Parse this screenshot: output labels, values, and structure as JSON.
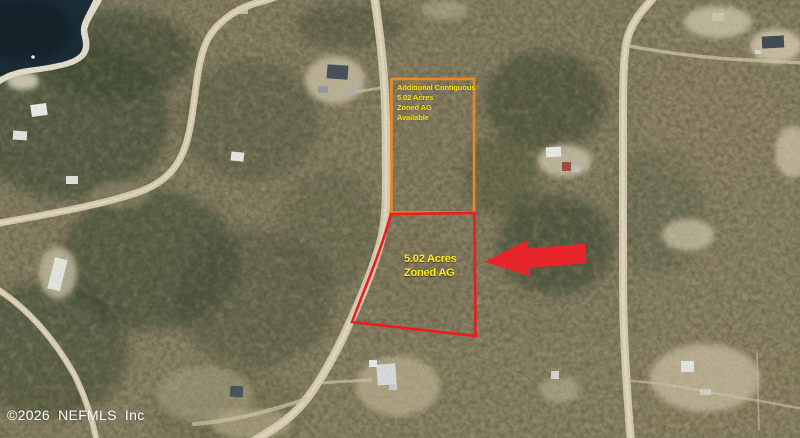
{
  "map": {
    "type": "aerial-parcel-map",
    "watermark": "©2026 NEFMLS Inc",
    "annotations": {
      "contiguous_parcel": {
        "outline_color": "#f08621",
        "label_color": "#ffe81c",
        "lines": [
          "Additional Contiguous",
          "5.02 Acres",
          "Zoned AG",
          "Available"
        ]
      },
      "subject_parcel": {
        "outline_color": "#ee1b1b",
        "label_color": "#ffe81c",
        "lines": [
          "5.02 Acres",
          "Zoned AG"
        ]
      },
      "arrow": {
        "icon": "arrow-left-icon",
        "color": "#e8252b"
      }
    }
  }
}
